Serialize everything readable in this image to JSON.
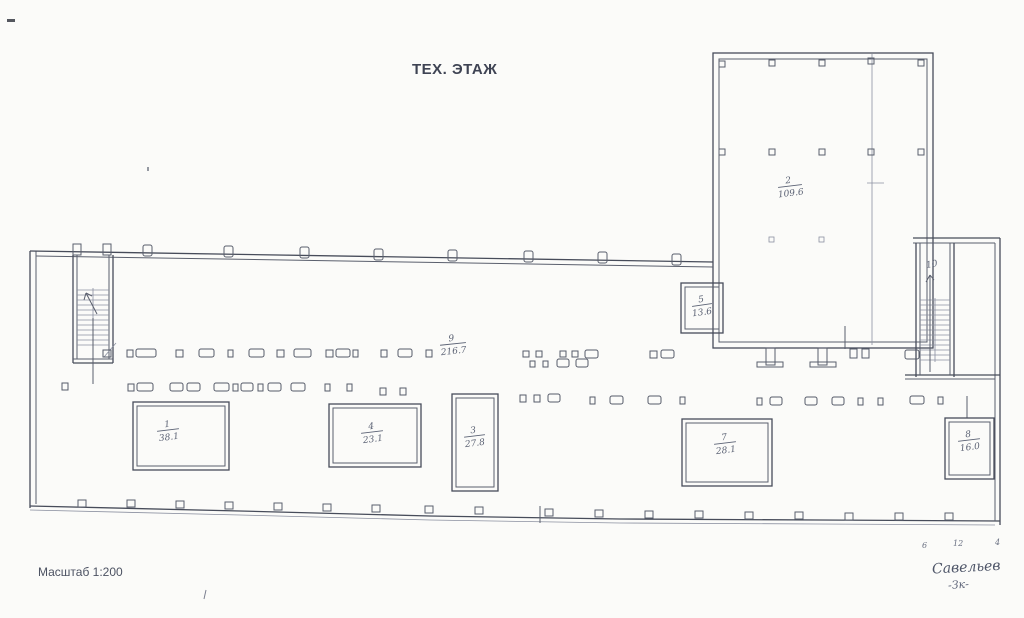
{
  "document": {
    "title": "ТЕХ. ЭТАЖ",
    "scale_label": "Масштаб 1:200",
    "signature": {
      "name": "Савельев",
      "flourish": "-Зк-"
    },
    "dimension_marks": [
      "6",
      "12",
      "4"
    ]
  },
  "rooms": {
    "r1": {
      "number": "1",
      "area": "38.1"
    },
    "r2": {
      "number": "2",
      "area": "109.6"
    },
    "r3": {
      "number": "3",
      "area": "27.8"
    },
    "r4": {
      "number": "4",
      "area": "23.1"
    },
    "r5": {
      "number": "5",
      "area": "13.6"
    },
    "r7": {
      "number": "7",
      "area": "28.1"
    },
    "r8": {
      "number": "8",
      "area": "16.0"
    },
    "r9": {
      "number": "9",
      "area": "216.7"
    },
    "r10": {
      "number": "10",
      "area": ""
    }
  }
}
